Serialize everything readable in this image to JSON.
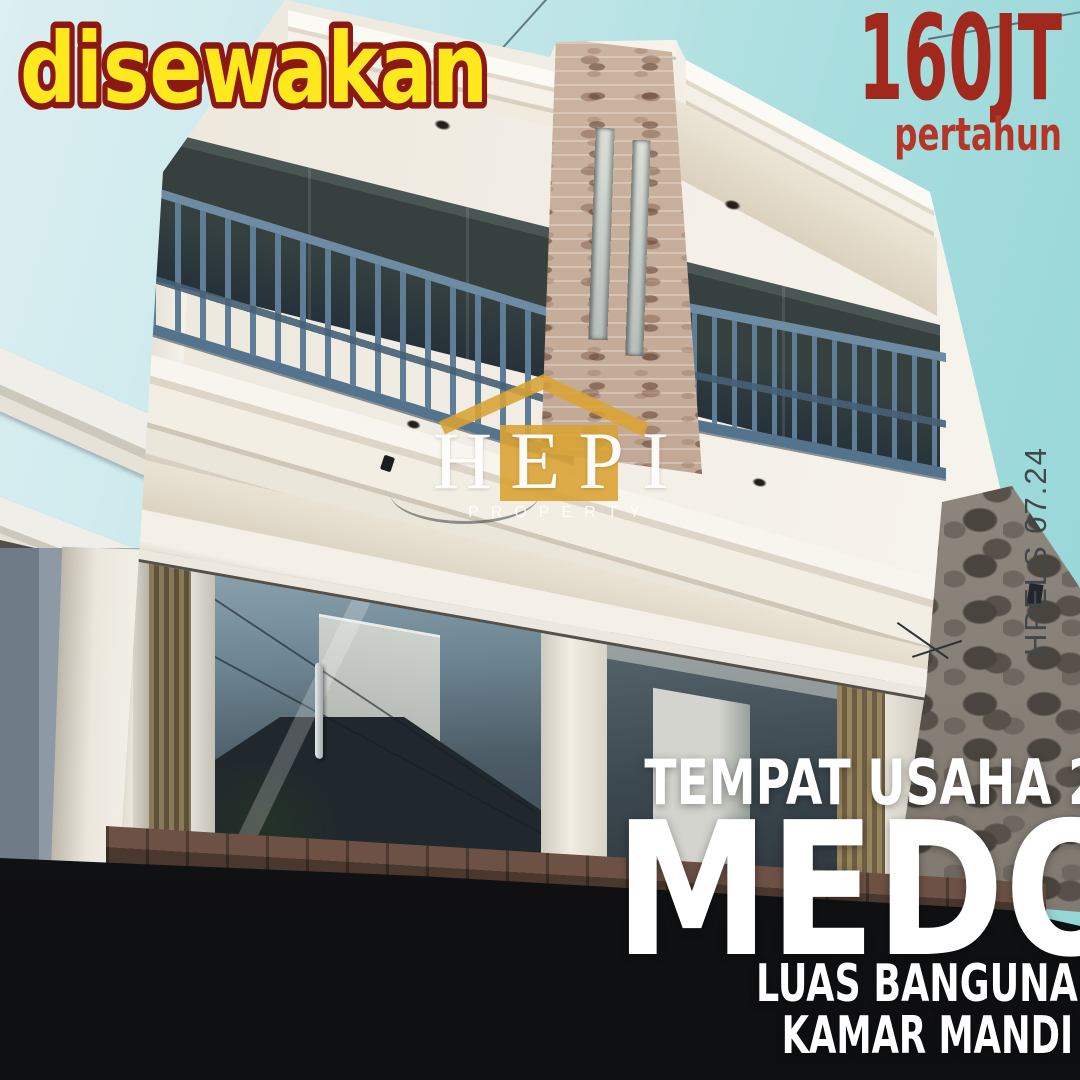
{
  "ad": {
    "badge": "disewakan",
    "price": "160JT",
    "price_period": "pertahun",
    "photo_code": "HPELS 07.24",
    "subtitle": "TEMPAT USAHA 2 LANTAI",
    "location_title": "MEDOHO",
    "spec_line1": "LUAS BANGUNAN 220M² (8,5M x 13M x 2 LANTAI)",
    "spec_line2": "KAMAR MANDI 2 | LISTRIK 14.000 WATT | AC 4 UNIT"
  },
  "watermark": {
    "brand": "HEPI",
    "brand_sub": "PROPERTY"
  },
  "colors": {
    "badge_fill": "#FFE81E",
    "badge_stroke": "#8C1911",
    "price_red": "#A1281C",
    "period_red": "#B43627",
    "watermark_gold": "#D9A334",
    "railing_blue": "#5E7E98",
    "sky_teal": "#9BD8D9",
    "facade_white": "#F3EFE7",
    "text_white": "#FFFFFF"
  }
}
